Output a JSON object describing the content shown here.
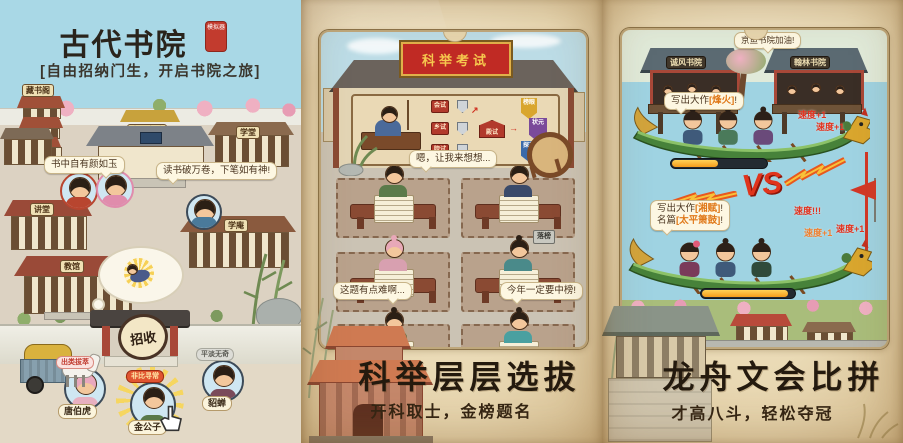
{
  "left": {
    "title": "古代书院",
    "seal": "模拟器",
    "tagline": "[自由招纳门生，开启书院之旅]",
    "buildings": {
      "library": "藏书阁",
      "gate": "古代书院",
      "school": "学堂",
      "lecture_hall": "讲堂",
      "study_hut": "学庵",
      "teach_hall": "教馆"
    },
    "bubble_jade": "书中自有颜如玉",
    "bubble_study": "读书破万卷，下笔如有神!",
    "recruit_sign": "招收",
    "candidates": [
      {
        "name": "唐伯虎",
        "tag": "出类拔萃"
      },
      {
        "name": "金公子",
        "tag": "非比寻常"
      },
      {
        "name": "貂蝉",
        "tag": "平淡无奇"
      }
    ]
  },
  "middle": {
    "banner": "科举考试",
    "stages": [
      "会试",
      "乡试",
      "院试",
      "殿试"
    ],
    "ranks": [
      "榜眼",
      "状元",
      "探花"
    ],
    "bubble_think": "嗯，让我来想想...",
    "fail_tag": "落榜",
    "bubble_hard": "这题有点难啊...",
    "bubble_pass": "今年一定要中榜!",
    "headline": "科举层层选拔",
    "subtitle": "开科取士，金榜题名"
  },
  "right": {
    "cheer_bubble": "京鱼书院加油!",
    "pavilion_left": "诚风书院",
    "pavilion_right": "翰林书院",
    "boat1": {
      "bubble_pre": "写出大作",
      "bubble_work": "[烽火]",
      "bubble_post": "!",
      "speed": [
        "速度+1",
        "速度+1"
      ]
    },
    "vs": "VS",
    "boat2": {
      "line1_pre": "写出大作",
      "line1_work": "[湘赋]",
      "line1_post": "!",
      "line2_pre": "名篇",
      "line2_work": "[太平箫鼓]",
      "line2_post": "!",
      "speed": [
        "速度!!!",
        "速度+1",
        "速度+1"
      ]
    },
    "headline": "龙舟文会比拼",
    "subtitle": "才高八斗，轻松夺冠"
  }
}
